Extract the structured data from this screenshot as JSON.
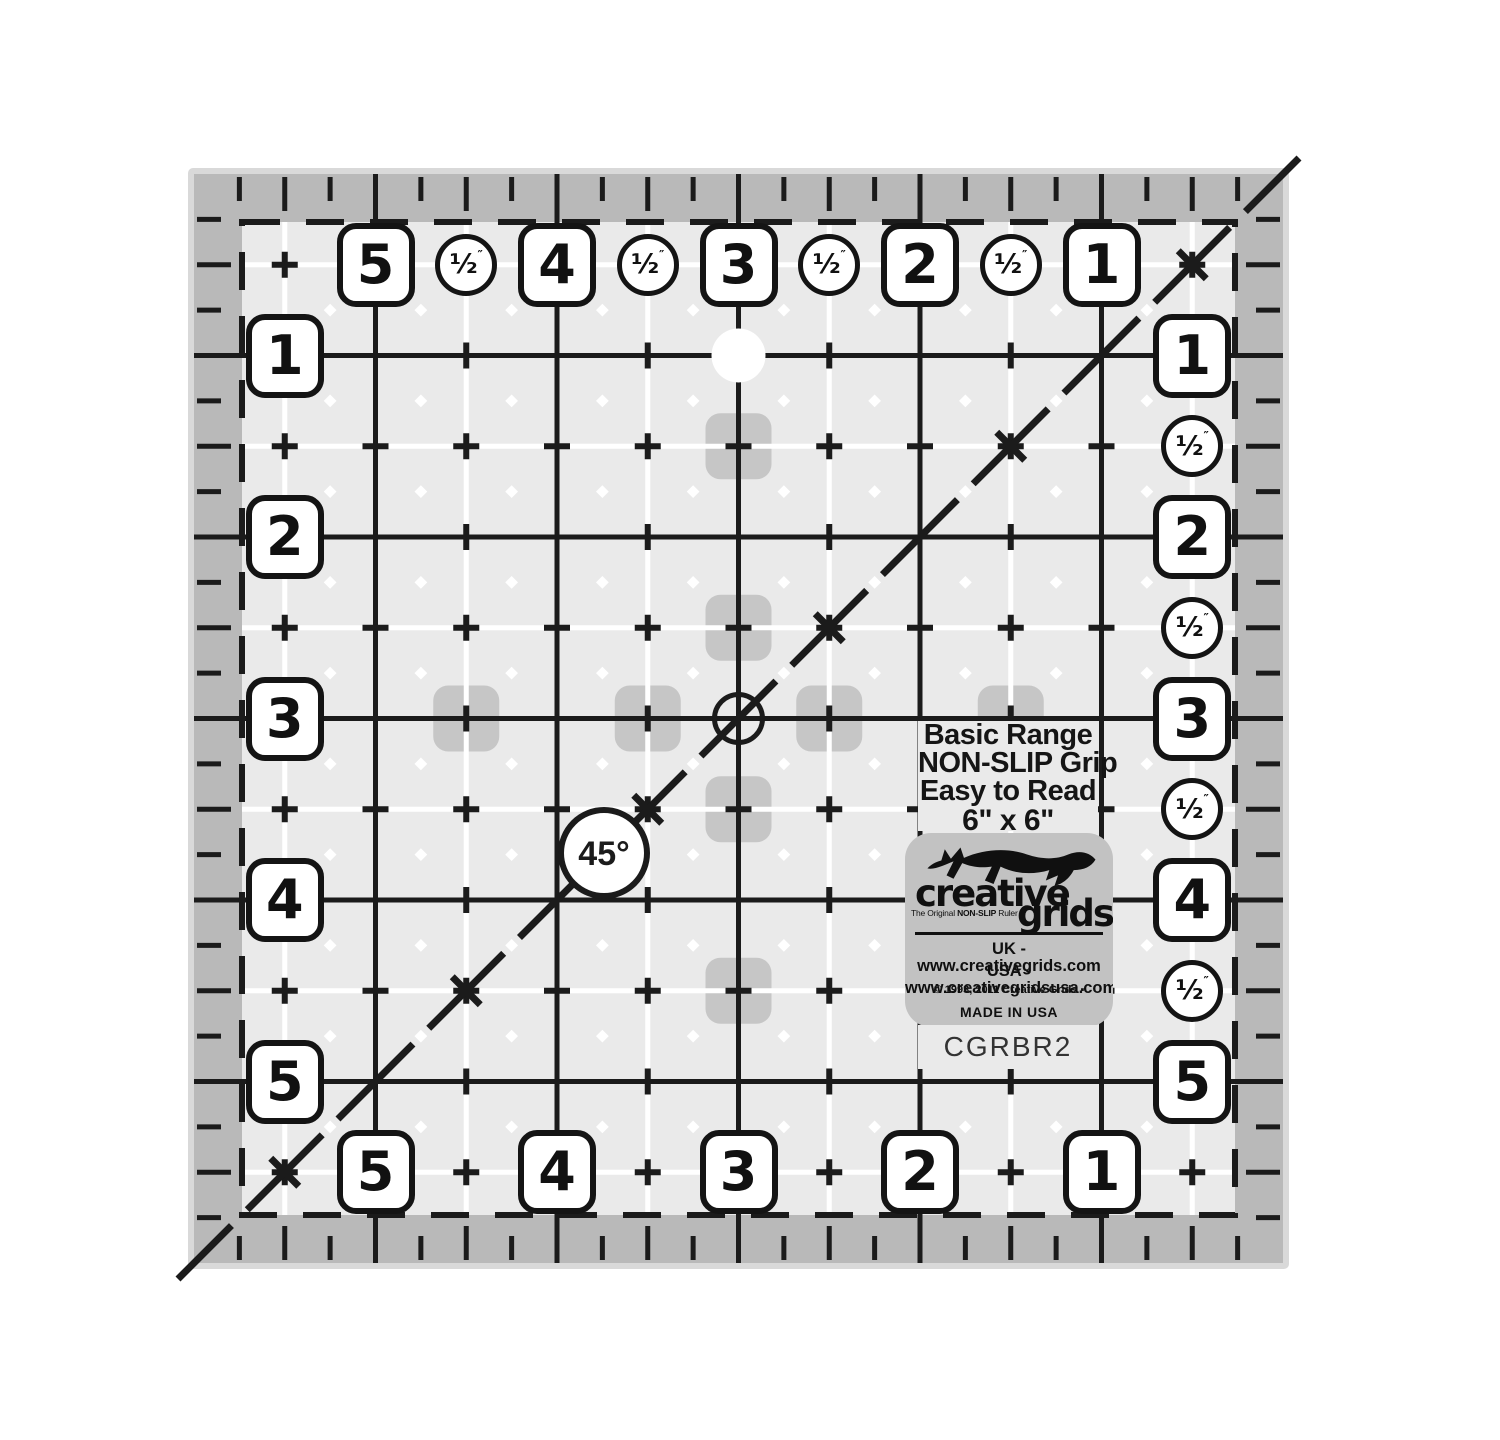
{
  "product": {
    "series_title": "Basic Range",
    "feature_grip": "NON-SLIP Grip",
    "feature_read": "Easy to Read",
    "size_label": "6\" x 6\"",
    "model_number": "CGRBR2"
  },
  "logo": {
    "fox_icon": "leaping-fox-icon",
    "brand_top": "creative",
    "brand_bottom": "grids",
    "registered_mark": "®",
    "tagline_prefix": "The Original",
    "tagline_bold": "NON-SLIP",
    "tagline_suffix": "Ruler",
    "uk_site_line": "UK - www.creativegrids.com",
    "usa_site_line": "USA - www.creativegridsusa.com",
    "copyright_line": "© 1993, 2011 Creative Grids ▪",
    "made_in_line": "MADE IN USA"
  },
  "ruler": {
    "angle_label": "45°",
    "half_inch_label": "½",
    "inch_mark": "″",
    "scales": {
      "top": [
        "5",
        "4",
        "3",
        "2",
        "1"
      ],
      "bottom": [
        "5",
        "4",
        "3",
        "2",
        "1"
      ],
      "left": [
        "1",
        "2",
        "3",
        "4",
        "5"
      ],
      "right": [
        "1",
        "2",
        "3",
        "4",
        "5"
      ]
    },
    "colors": {
      "line": "#1b1b1b",
      "interior": "#eaeaea",
      "border_strip": "#b9b9b9",
      "edge_highlight": "#d9d9d9",
      "grip_patch": "#c6c6c6",
      "logo_panel": "#c2c2c2",
      "marking_white": "#ffffff"
    }
  }
}
